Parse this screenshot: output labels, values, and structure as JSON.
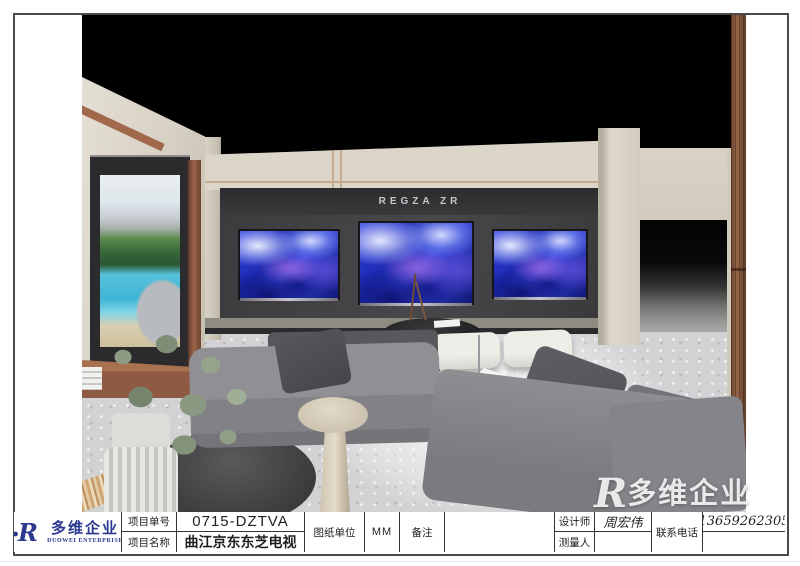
{
  "logo": {
    "brand_cn": "多维企业",
    "brand_en": "DUOWEI ENTERPRISE",
    "brand_color": "#2b3990"
  },
  "title_block": {
    "project_no": {
      "label": "项目单号",
      "value": "0715-DZTVA"
    },
    "project_name": {
      "label": "项目名称",
      "value": "曲江京东东芝电视"
    },
    "drawing_unit": {
      "label": "图纸单位",
      "value": "MM"
    },
    "remark": {
      "label": "备注",
      "value": ""
    },
    "designer": {
      "label": "设计师",
      "value": "周宏伟"
    },
    "surveyor": {
      "label": "测量人",
      "value": ""
    },
    "phone": {
      "label": "联系电话",
      "value": "13659262305"
    }
  },
  "render": {
    "sign": "REGZA ZR",
    "watermark_r": "R",
    "watermark": "多维企业",
    "palette": {
      "ceiling": "#000000",
      "wall_beige": "#dcd6c9",
      "tv_alcove": "#3c3c3e",
      "floor": "#d2d2d4",
      "copper_trim": "#9a644a",
      "wood_pillar": "#8a5c41",
      "sofa_gray": "#8a8a8e",
      "ottoman_white": "#efede7",
      "tv_art_blue": "#2233cc",
      "sign_silver": "#c7c7cc"
    }
  }
}
